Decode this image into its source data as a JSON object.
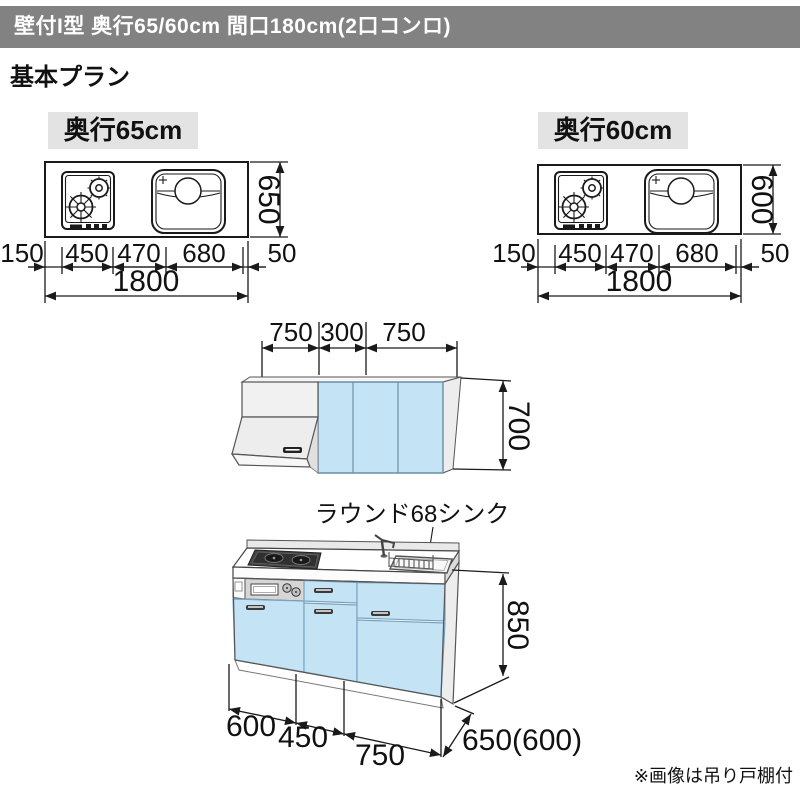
{
  "header": {
    "title": "壁付I型 奥行65/60cm 間口180cm(2口コンロ)"
  },
  "section_title": "基本プラン",
  "plan65": {
    "label": "奥行65cm",
    "depth": "650",
    "widths": [
      "150",
      "450",
      "470",
      "680",
      "50"
    ],
    "total": "1800"
  },
  "plan60": {
    "label": "奥行60cm",
    "depth": "600",
    "widths": [
      "150",
      "450",
      "470",
      "680",
      "50"
    ],
    "total": "1800"
  },
  "wall_cabinet": {
    "widths": [
      "750",
      "300",
      "750"
    ],
    "height": "700"
  },
  "base_unit": {
    "sink_label": "ラウンド68シンク",
    "height": "850",
    "widths": [
      "600",
      "450",
      "750"
    ],
    "depth": "650(600)"
  },
  "footnote": "※画像は吊り戸棚付",
  "colors": {
    "header_bg": "#828282",
    "label_bg": "#e3e3e3",
    "cabinet_blue": "#c4e4f6",
    "panel_gray": "#ededed",
    "note_gray": "#9a9a9a"
  }
}
